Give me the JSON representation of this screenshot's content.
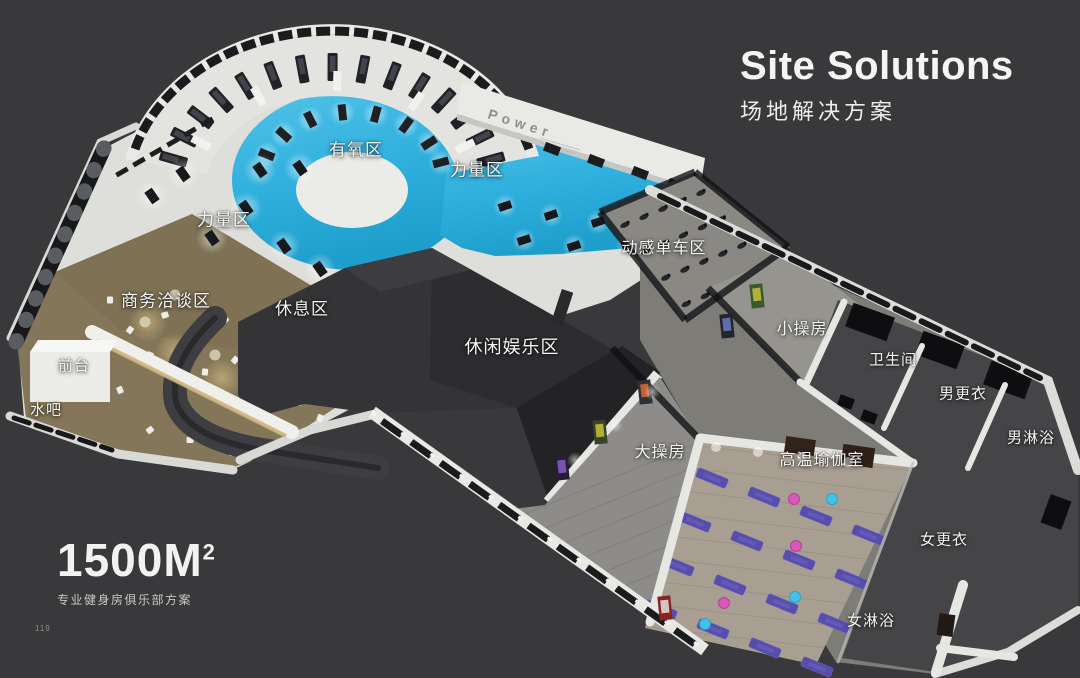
{
  "page": {
    "number": "119",
    "background": "#39383a"
  },
  "header": {
    "title": "Site Solutions",
    "subtitle": "场地解决方案"
  },
  "footer": {
    "area_value": "1500M",
    "area_exponent": "2",
    "description": "专业健身房俱乐部方案"
  },
  "floor_plan": {
    "wall_text": "Power",
    "areas": [
      {
        "id": "cardio",
        "label": "有氧区"
      },
      {
        "id": "strength-right",
        "label": "力量区"
      },
      {
        "id": "strength-left",
        "label": "力量区"
      },
      {
        "id": "spinning",
        "label": "动感单车区"
      },
      {
        "id": "business",
        "label": "商务洽谈区"
      },
      {
        "id": "rest",
        "label": "休息区"
      },
      {
        "id": "front-desk",
        "label": "前台"
      },
      {
        "id": "water-bar",
        "label": "水吧"
      },
      {
        "id": "leisure",
        "label": "休闲娱乐区"
      },
      {
        "id": "big-studio",
        "label": "大操房"
      },
      {
        "id": "small-studio",
        "label": "小操房"
      },
      {
        "id": "restroom",
        "label": "卫生间"
      },
      {
        "id": "men-locker",
        "label": "男更衣"
      },
      {
        "id": "men-shower",
        "label": "男淋浴"
      },
      {
        "id": "hot-yoga",
        "label": "高温瑜伽室"
      },
      {
        "id": "women-locker",
        "label": "女更衣"
      },
      {
        "id": "women-shower",
        "label": "女淋浴"
      }
    ],
    "colors": {
      "background": "#39383a",
      "blue_floor": "#2fb0dd",
      "wall_white": "#e8e8e4",
      "roof_charcoal": "#343437",
      "carpet_tan": "#857759",
      "mat_purple": "#574eac",
      "ball_pink": "#db58b8",
      "ball_cyan": "#43c2e8"
    }
  }
}
